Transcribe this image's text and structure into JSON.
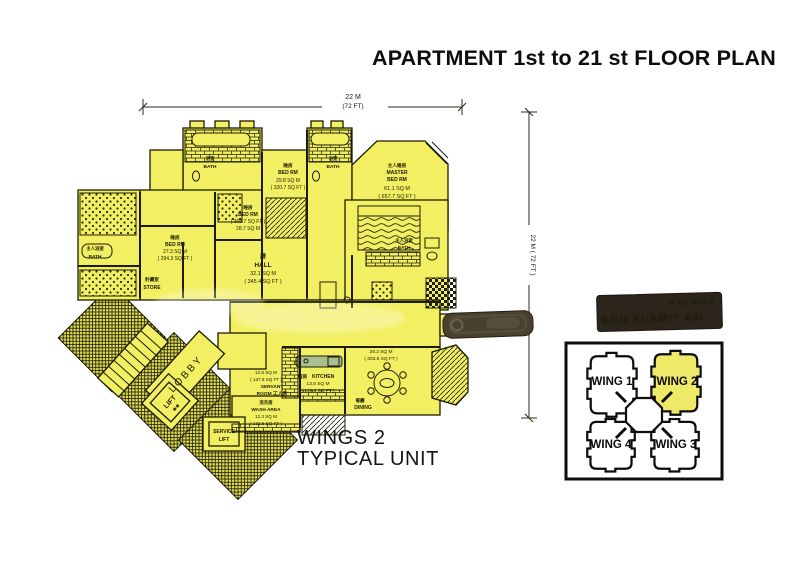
{
  "title": "APARTMENT 1st to 21 st FLOOR PLAN",
  "caption": {
    "line1": "WINGS 2",
    "line2": "TYPICAL UNIT"
  },
  "dimensions": {
    "width_m": "22 M",
    "width_ft": "(72 FT)",
    "height": "22 M ( 72 FT )"
  },
  "colors": {
    "plan_yellow": "#f2ef62",
    "ink": "#1c1c05",
    "wing_highlight": "#efe96a",
    "counter_green": "#a9bf8e",
    "stamp_brown": "#49402f",
    "stamp_dark": "#2c251c",
    "stamp_text": "#8d7c63",
    "paper": "#ffffff"
  },
  "plan": {
    "rooms": {
      "master": {
        "zh": "主人睡房",
        "en1": "MASTER",
        "en2": "BED RM",
        "m": "61.1 SQ M",
        "ft": "( 657.7 SQ FT )"
      },
      "bed_top": {
        "zh": "睡房",
        "en": "BED RM",
        "m": "29.8 SQ M",
        "ft": "( 320.7 SQ FT )"
      },
      "bed_mid": {
        "zh": "睡房",
        "en": "BED RM",
        "ft": "( 308.7 SQ FT )",
        "m": "28.7 SQ M"
      },
      "bed_left": {
        "zh": "睡房",
        "en": "BED RM",
        "m": "27.3 SQ M",
        "ft": "( 294.3 SQ FT )"
      },
      "hall": {
        "zh": "廳",
        "en": "HALL",
        "m": "32.1 SQ M",
        "ft": "( 345.4 SQ FT )"
      },
      "store": {
        "zh": "貯藏室",
        "en": "STORE"
      },
      "bath_master_l": {
        "zh": "主人浴室",
        "en": "BATH"
      },
      "bath1": {
        "zh": "浴室",
        "en": "BATH"
      },
      "bath2": {
        "zh": "浴室",
        "en": "BATH"
      },
      "bath_master_r": {
        "zh": "主人浴室",
        "en": "BATH"
      },
      "kitchen": {
        "zh": "廚房",
        "en": "KITCHEN",
        "m": "13.8 SQ M",
        "ft": "( 148.5 SQ FT )"
      },
      "dining": {
        "zh": "餐廳",
        "en": "DINING",
        "m": "28.2 SQ M",
        "ft": "( 303.8 SQ FT )"
      },
      "servant": {
        "m": "12.8 SQ M",
        "ft": "( 137.9 SQ FT )",
        "en1": "SERVANT",
        "en2": "ROOM 工人房"
      },
      "wash": {
        "zh": "洗衣房",
        "en": "WASH AREA",
        "m": "12.3 SQ M",
        "ft": "( 132.6 SQ FT )"
      },
      "lobby": {
        "en": "LOBBY"
      },
      "lift": {
        "en": "LIFT",
        "stars": "✱✱"
      },
      "service_lift": {
        "en1": "SERVICE",
        "en2": "LIFT"
      }
    }
  },
  "key_plan": {
    "wing1": "WING 1",
    "wing2": "WING 2",
    "wing3": "WING 3",
    "wing4": "WING 4",
    "highlighted_wing": "WING 2"
  },
  "stamps": {
    "large_line1": "8 IG OIRA",
    "large_line2": "BMG FORMIT 8di"
  }
}
